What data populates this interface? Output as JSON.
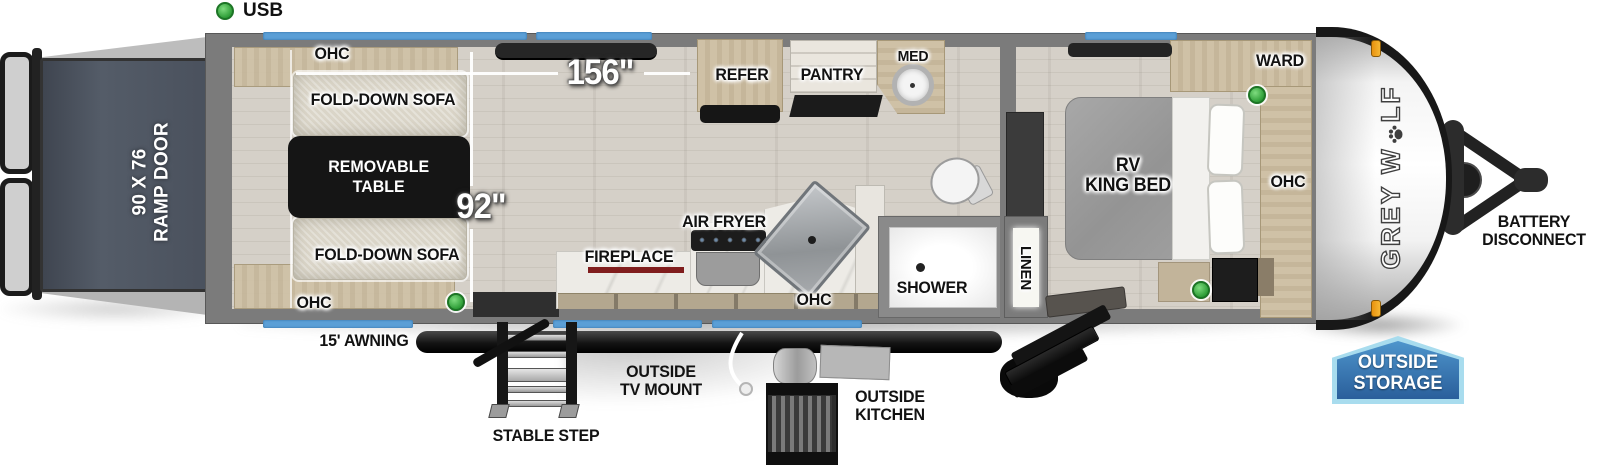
{
  "legend": {
    "usb": "USB"
  },
  "garage": {
    "ohc_top": "OHC",
    "sofa_top": "FOLD-DOWN SOFA",
    "table_line1": "REMOVABLE",
    "table_line2": "TABLE",
    "sofa_bottom": "FOLD-DOWN SOFA",
    "ohc_bottom": "OHC",
    "ramp_door_line1": "90 X 76",
    "ramp_door_line2": "RAMP DOOR"
  },
  "dimensions": {
    "cargo_length": "156\"",
    "cargo_width": "92\""
  },
  "kitchen": {
    "refer": "REFER",
    "pantry": "PANTRY",
    "fireplace": "FIREPLACE",
    "air_fryer": "AIR FRYER",
    "ohc": "OHC"
  },
  "bath": {
    "med": "MED",
    "shower": "SHOWER",
    "linen": "LINEN"
  },
  "bedroom": {
    "ward": "WARD",
    "bed_line1": "RV",
    "bed_line2": "KING BED",
    "ohc": "OHC"
  },
  "exterior": {
    "awning": "15' AWNING",
    "outside_tv_line1": "OUTSIDE",
    "outside_tv_line2": "TV MOUNT",
    "stable_step": "STABLE STEP",
    "outside_kitchen_line1": "OUTSIDE",
    "outside_kitchen_line2": "KITCHEN",
    "storage_line1": "OUTSIDE",
    "storage_line2": "STORAGE",
    "battery_line1": "BATTERY",
    "battery_line2": "DISCONNECT",
    "brand_part1": "GREY W",
    "brand_part2": "LF"
  },
  "colors": {
    "window_blue": "#5b9fd6",
    "storage_badge_blue": "#2a5f9b",
    "storage_badge_border": "#a8dcee",
    "usb_green": "#2f9e38",
    "fireplace_red": "#801d1d",
    "marker_light_orange": "#f0a429",
    "ramp_door_gray": "#4a515d",
    "wall_gray": "#7b7b7b"
  }
}
